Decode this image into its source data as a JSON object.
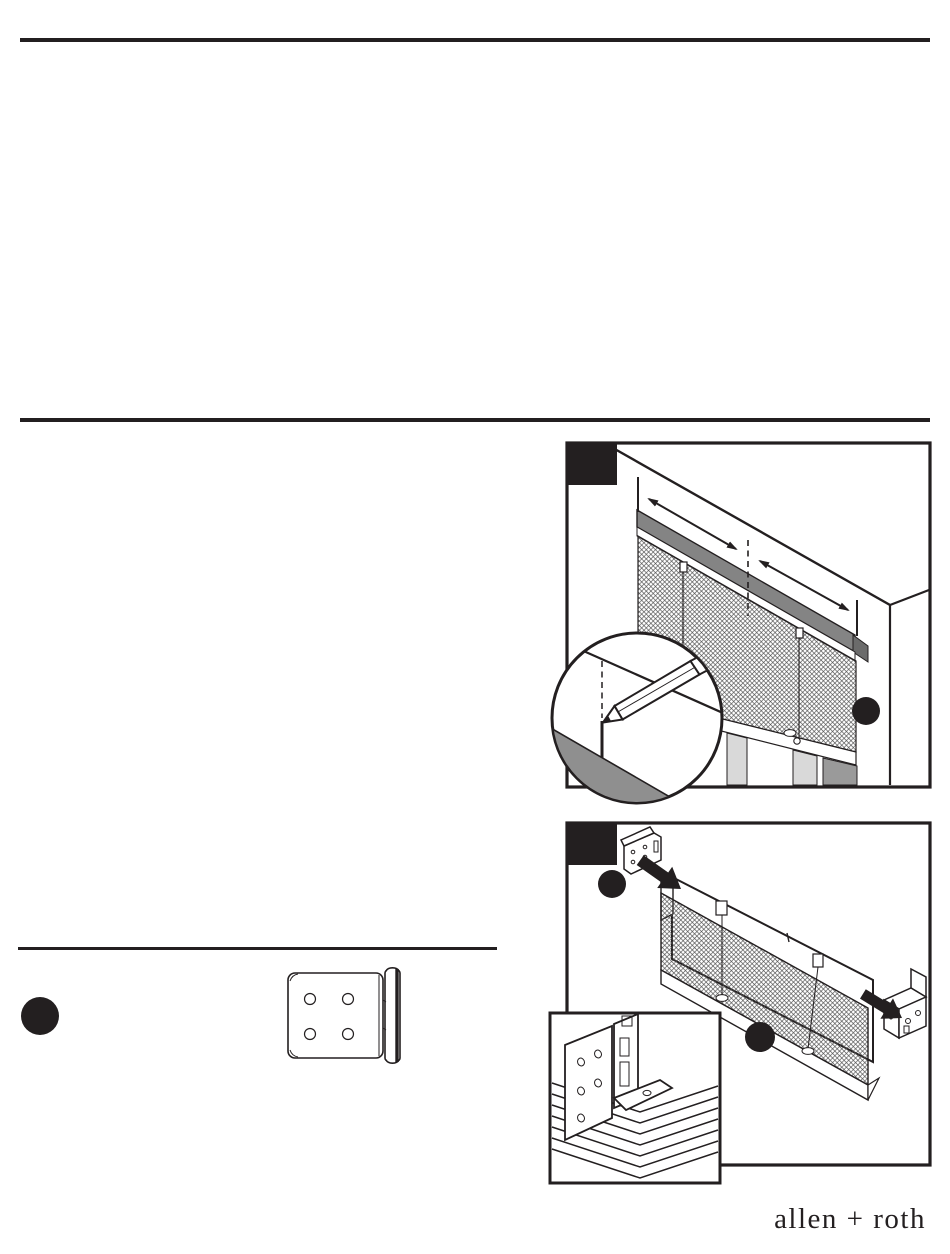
{
  "page": {
    "kind": "blind installation instruction sheet (scanned page)",
    "background": "#ffffff",
    "ink_color": "#231f20",
    "headrail_gray": "#848484",
    "sill_gray": "#8f8f8f",
    "bar_light_gray": "#d9d9d9",
    "bar_dark_gray": "#9a9a9a"
  },
  "logo": {
    "text": "allen + roth"
  },
  "figures": {
    "fig1": {
      "label": "measure-window-and-mark-with-pencil",
      "step_badge": "filled-black-square",
      "callout": "filled-black-dot",
      "contents": "window frame in perspective, blind headrail band, pleated shade, two double-headed width arrows, center dashed line, magnifier circle with pencil marking"
    },
    "fig2": {
      "label": "attach-brackets-to-headrail-ends",
      "step_badge": "filled-black-square",
      "callouts": 2,
      "contents": "headrail with pleated stack, left and right mounting brackets with black attach arrows, corner detail inset"
    },
    "parts": {
      "label": "mounting-bracket-top-view",
      "callout": "filled-black-dot",
      "holes": 4
    }
  }
}
